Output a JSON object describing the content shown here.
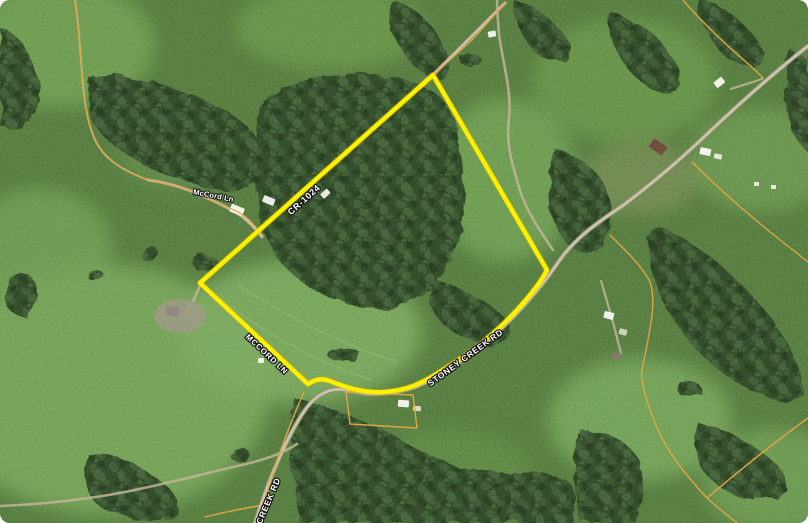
{
  "map": {
    "road_labels": [
      {
        "id": "mccord-ln-small",
        "text": "McCord Ln"
      },
      {
        "id": "cr-1024",
        "text": "CR-1024"
      },
      {
        "id": "mccord-ln",
        "text": "MCCORD LN"
      },
      {
        "id": "stoney-creek-rd",
        "text": "STONEY CREEK RD"
      },
      {
        "id": "creek-rd",
        "text": "CREEK RD"
      }
    ],
    "colors": {
      "property_boundary": "#fdf000",
      "property_boundary_glow": "#d8b500",
      "parcel_line": "#e2a33c",
      "road_fill": "#c7c0a5",
      "road_casing": "#8e8973",
      "path_fill": "#bdb292",
      "label_text": "#ffffff",
      "label_outline": "#141414"
    }
  }
}
